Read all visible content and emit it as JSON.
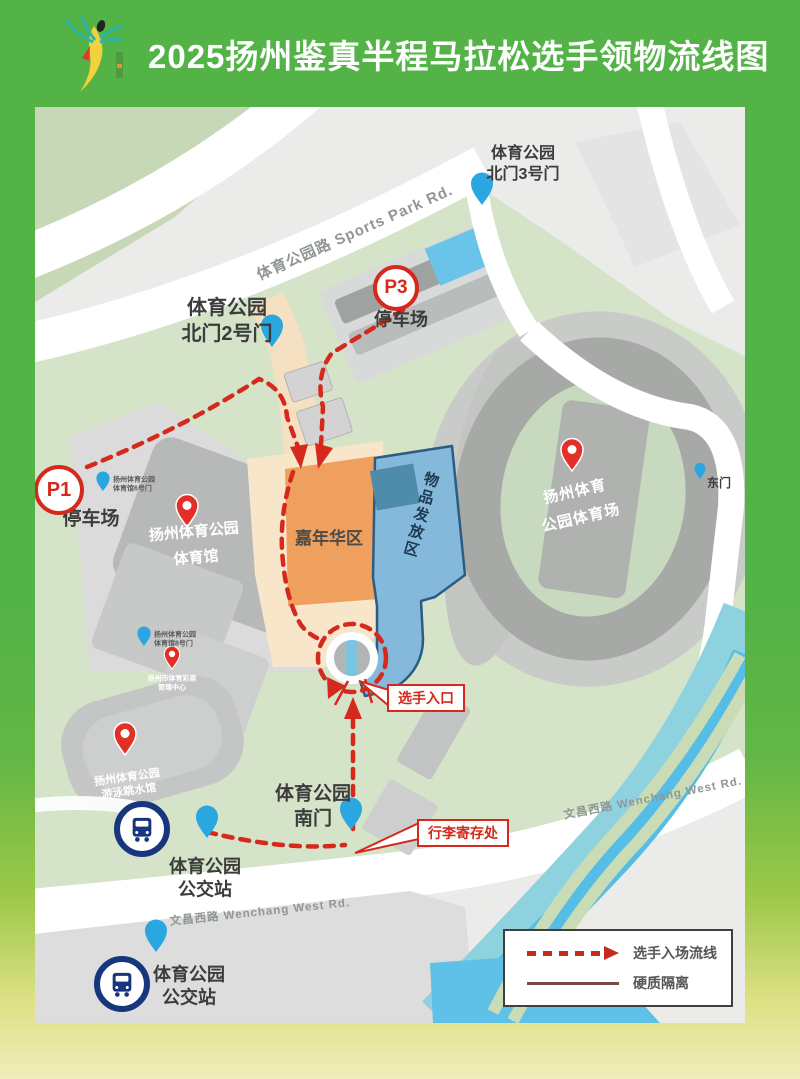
{
  "header": {
    "title": "2025扬州鉴真半程马拉松选手领物流线图"
  },
  "map": {
    "roads": {
      "sports_park": "体育公园路   Sports Park Rd.",
      "wenchang_east": "文昌西路   Wenchang West Rd.",
      "wenchang_west": "文昌西路   Wenchang West Rd."
    },
    "gates": {
      "north3": "体育公园\n北门3号门",
      "north2": "体育公园\n北门2号门",
      "south": "体育公园\n南门",
      "east": "东门"
    },
    "parking": {
      "p3_badge": "P3",
      "p3_label": "停车场",
      "p1_badge": "P1",
      "p1_label": "停车场"
    },
    "venues": {
      "stadium": "扬州体育\n公园体育场",
      "gymnasium": "扬州体育公园\n体育馆",
      "swim_hall": "扬州体育公园\n游泳跳水馆",
      "lottery_center": "扬州市体育彩票\n管理中心",
      "gym_gate6": "扬州体育公园\n体育馆6号门",
      "gym_gate8": "扬州体育公园\n体育馆8号门"
    },
    "zones": {
      "carnival": "嘉年华区",
      "distribution": "物品发放区"
    },
    "callouts": {
      "athlete_entrance": "选手入口",
      "luggage_storage": "行李寄存处"
    },
    "bus_stations": {
      "station1": "体育公园\n公交站",
      "station2": "体育公园\n公交站"
    }
  },
  "legend": {
    "flow_line": "选手入场流线",
    "isolation": "硬质隔离"
  },
  "colors": {
    "header_green": "#54b347",
    "route_red": "#d4291c",
    "carnival_orange": "#efa05e",
    "distribution_blue": "#85b9dc",
    "pin_blue": "#2aa7e0",
    "pin_red": "#e23027",
    "bottom_cream": "#f1edbc"
  }
}
